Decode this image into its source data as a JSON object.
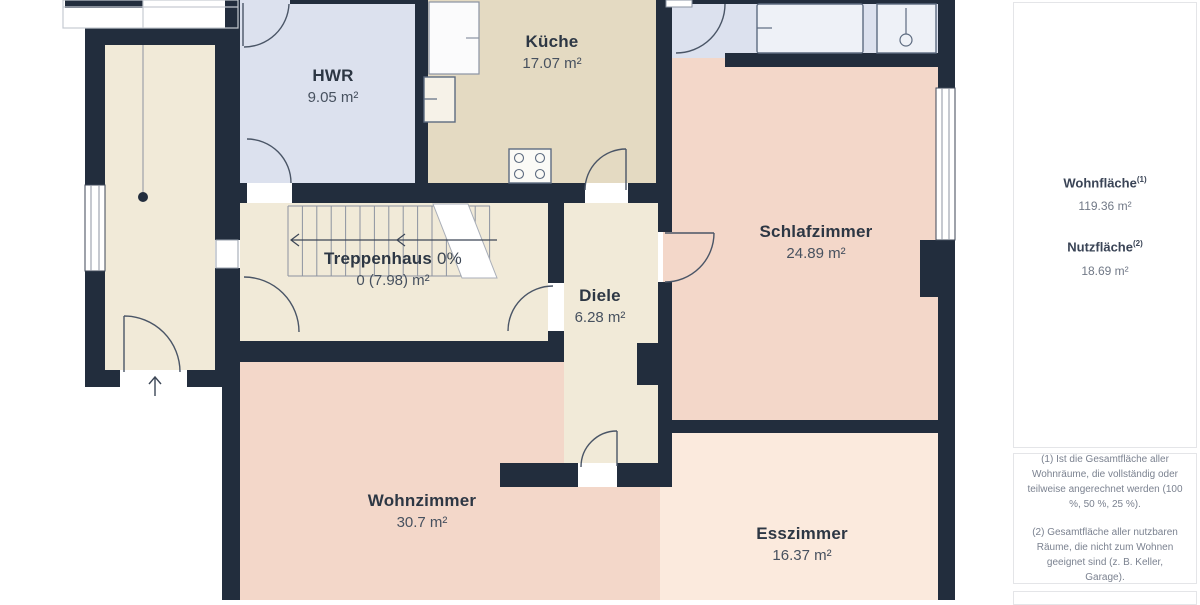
{
  "plan": {
    "rooms": [
      {
        "id": "hwr",
        "name": "HWR",
        "area": "9.05 m²"
      },
      {
        "id": "kueche",
        "name": "Küche",
        "area": "17.07 m²"
      },
      {
        "id": "schlafzimmer",
        "name": "Schlafzimmer",
        "area": "24.89 m²"
      },
      {
        "id": "treppenhaus",
        "name": "Treppenhaus",
        "suffix": "0%",
        "area": "0 (7.98) m²"
      },
      {
        "id": "diele",
        "name": "Diele",
        "area": "6.28 m²"
      },
      {
        "id": "wohnzimmer",
        "name": "Wohnzimmer",
        "area": "30.7 m²"
      },
      {
        "id": "esszimmer",
        "name": "Esszimmer",
        "area": "16.37 m²"
      }
    ],
    "colors": {
      "wall": "#222d3d",
      "utility_blue": "#dce1ee",
      "kitchen_beige": "#e4dac2",
      "hall_cream": "#f1ead8",
      "living_pink": "#f3d7c9",
      "dining_peach": "#fbeadd",
      "window_white": "#ffffff"
    }
  },
  "sidebar": {
    "wohnflaeche_label": "Wohnfläche",
    "wohnflaeche_sup": "(1)",
    "wohnflaeche_value": "119.36 m²",
    "nutzflaeche_label": "Nutzfläche",
    "nutzflaeche_sup": "(2)",
    "nutzflaeche_value": "18.69 m²",
    "footnote_1": "(1) Ist die Gesamtfläche aller Wohnräume, die vollständig oder teilweise angerechnet werden (100 %, 50 %, 25 %).",
    "footnote_2": "(2) Gesamtfläche aller nutzbaren Räume, die nicht zum Wohnen geeignet sind (z. B. Keller, Garage)."
  }
}
